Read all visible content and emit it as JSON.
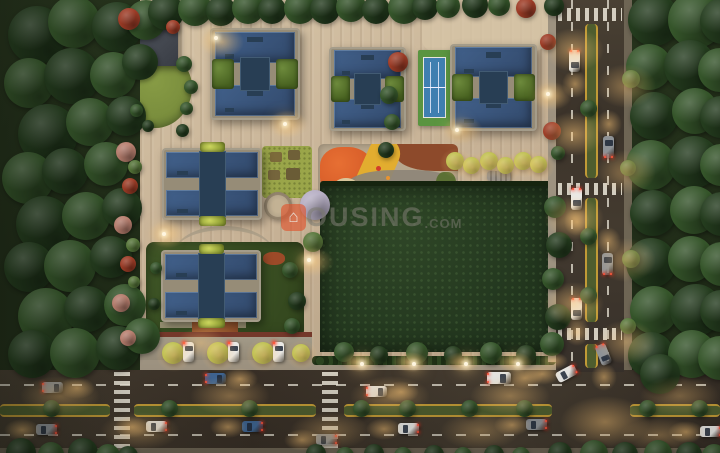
{
  "watermark": {
    "logo_glyph": "⌂",
    "text": "OUSING",
    "suffix": ".COM",
    "full_text": "HOUSING.COM"
  },
  "scene_labels": {
    "site": "residential-complex-aerial-dusk",
    "amenities": [
      "clubhouse",
      "tennis-court",
      "kids-playground",
      "central-lawn",
      "circular-plaza",
      "tree-lined-parking"
    ]
  },
  "colors": {
    "paving": "#c7b296",
    "paving_hi": "#d9c7a9",
    "paving_lo": "#ab977b",
    "road": "#42392e",
    "sidewalk": "#9d9280",
    "sidewalk_dark": "#6e6554",
    "lane_white": "#ddd8ca",
    "lane_yellow": "#c19a36",
    "median_green": "#4e5d2e",
    "forest_base": "#202c18",
    "tree_dark": "#243c1e",
    "tree_mid": "#35552a",
    "tree_light": "#567539",
    "tree_red": "#9e3c26",
    "tree_pink": "#b97f6f",
    "tree_lilac": "#b6aec4",
    "tree_yellow": "#b4bf4a",
    "lawn_bright": "#7a8e3d",
    "lawn_garden": "#9aa549",
    "lawn_dark": "#22361e",
    "hedge_red": "#74382a",
    "roof_blue": "#41608a",
    "roof_blue_dark": "#32496b",
    "roof_core": "#283e54",
    "parapet": "#968c77",
    "clubhouse": "#43474f",
    "tennis_green": "#5a9440",
    "tennis_blue": "#3f7fb0",
    "pg_base": "#b7a78e",
    "pg_orange": "#d95f2a",
    "pg_yellow": "#e2ad2f",
    "pg_mulch": "#8d4a2b",
    "pg_path": "#8d8578",
    "pg_sand": "#d9c69b",
    "plaza": "#b3a48a",
    "car_white": "#e9e8e4",
    "car_grey": "#8e9296",
    "car_blue": "#3f6592",
    "glow_warm": "#ffc87d",
    "flare": "#fff6e0",
    "wm_text": "#7d7c72",
    "wm_orange": "#e0542c"
  }
}
